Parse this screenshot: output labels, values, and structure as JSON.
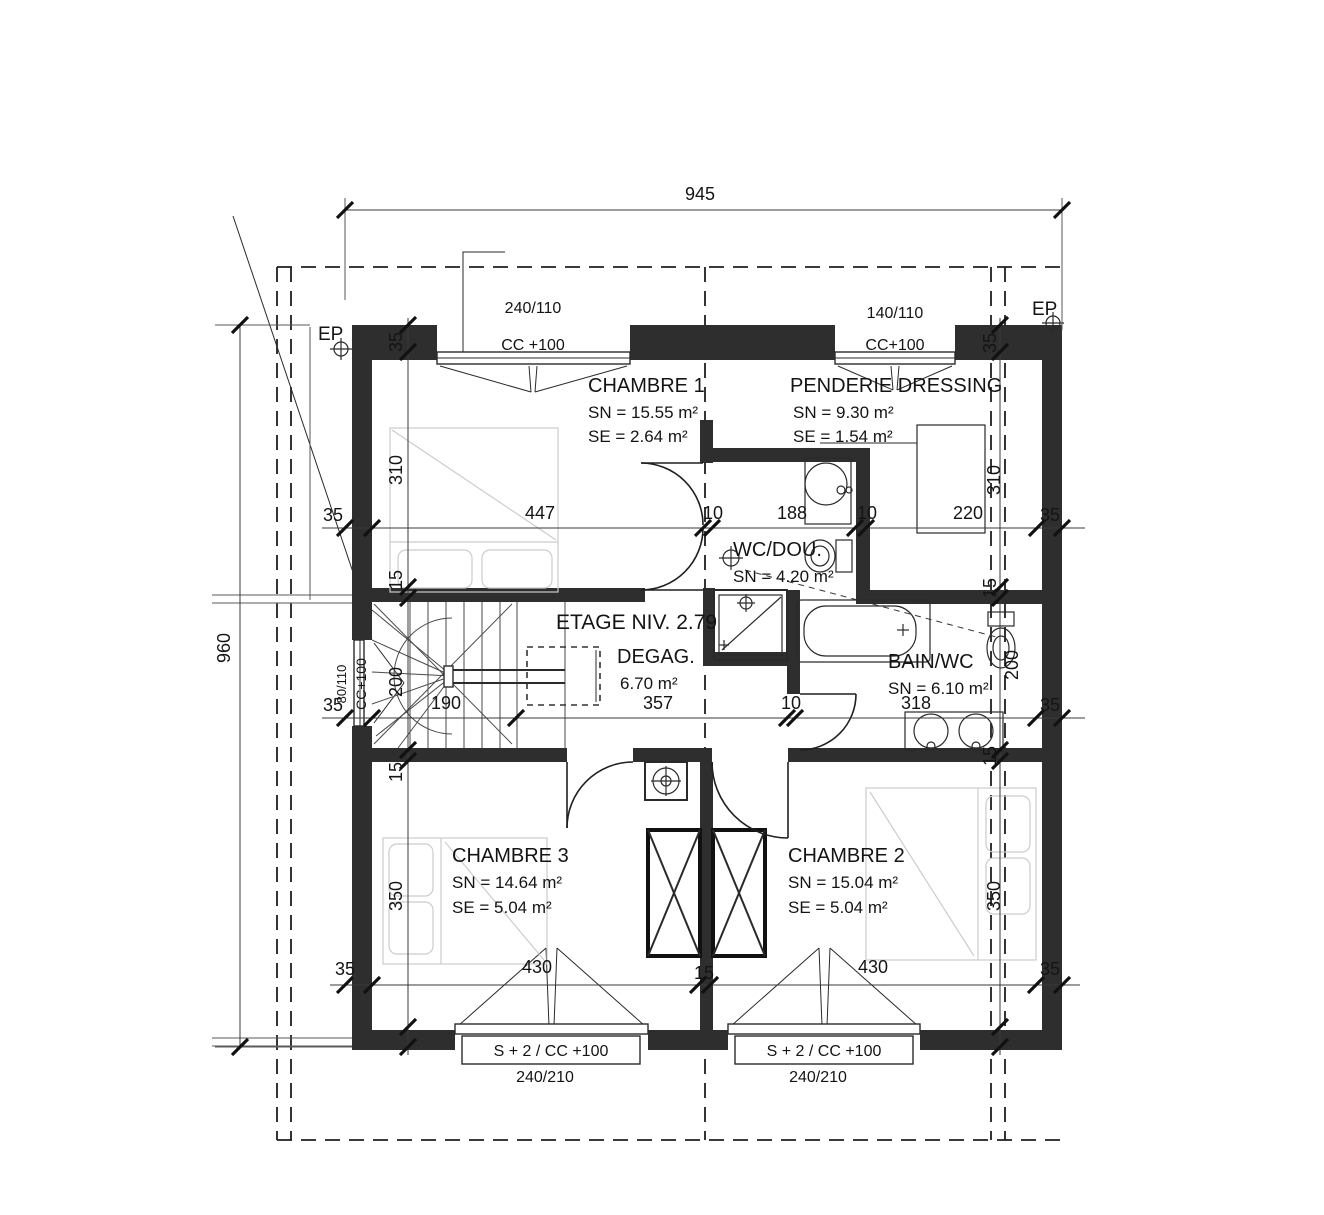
{
  "plan": {
    "level_label": "ETAGE NIV. 2.79",
    "ep_left": "EP",
    "ep_right": "EP",
    "rooms": {
      "chambre1": {
        "name": "CHAMBRE 1",
        "sn": "SN = 15.55 m²",
        "se": "SE =  2.64 m²"
      },
      "penderie": {
        "name": "PENDERIE DRESSING",
        "sn": "SN =  9.30 m²",
        "se": "SE =  1.54 m²"
      },
      "wc_douche": {
        "name": "WC/DOU.",
        "sn": "SN = 4.20 m²"
      },
      "degagement": {
        "name": "DEGAG.",
        "area": "6.70 m²"
      },
      "bain_wc": {
        "name": "BAIN/WC",
        "sn": "SN = 6.10 m²"
      },
      "chambre3": {
        "name": "CHAMBRE 3",
        "sn": "SN = 14.64 m²",
        "se": "SE =  5.04 m²"
      },
      "chambre2": {
        "name": "CHAMBRE 2",
        "sn": "SN = 15.04 m²",
        "se": "SE =  5.04 m²"
      }
    },
    "windows": {
      "top_left": {
        "size": "240/110",
        "sill": "CC +100"
      },
      "top_right": {
        "size": "140/110",
        "sill": "CC+100"
      },
      "left": {
        "size": "80/110",
        "sill": "CC+100"
      },
      "bottom_left": {
        "size": "240/210",
        "sill": "S + 2 / CC +100"
      },
      "bottom_right": {
        "size": "240/210",
        "sill": "S + 2 / CC +100"
      }
    },
    "dimensions": {
      "overall_width": "945",
      "overall_height": "960",
      "row_upper": [
        "35",
        "447",
        "10",
        "188",
        "10",
        "220",
        "35"
      ],
      "row_middle": [
        "35",
        "190",
        "357",
        "10",
        "318",
        "35"
      ],
      "row_bottom": [
        "35",
        "430",
        "15",
        "430",
        "35"
      ],
      "col_left": [
        "35",
        "310",
        "15",
        "200",
        "15",
        "350"
      ],
      "col_right": [
        "35",
        "310",
        "15",
        "200",
        "15",
        "350"
      ]
    }
  }
}
